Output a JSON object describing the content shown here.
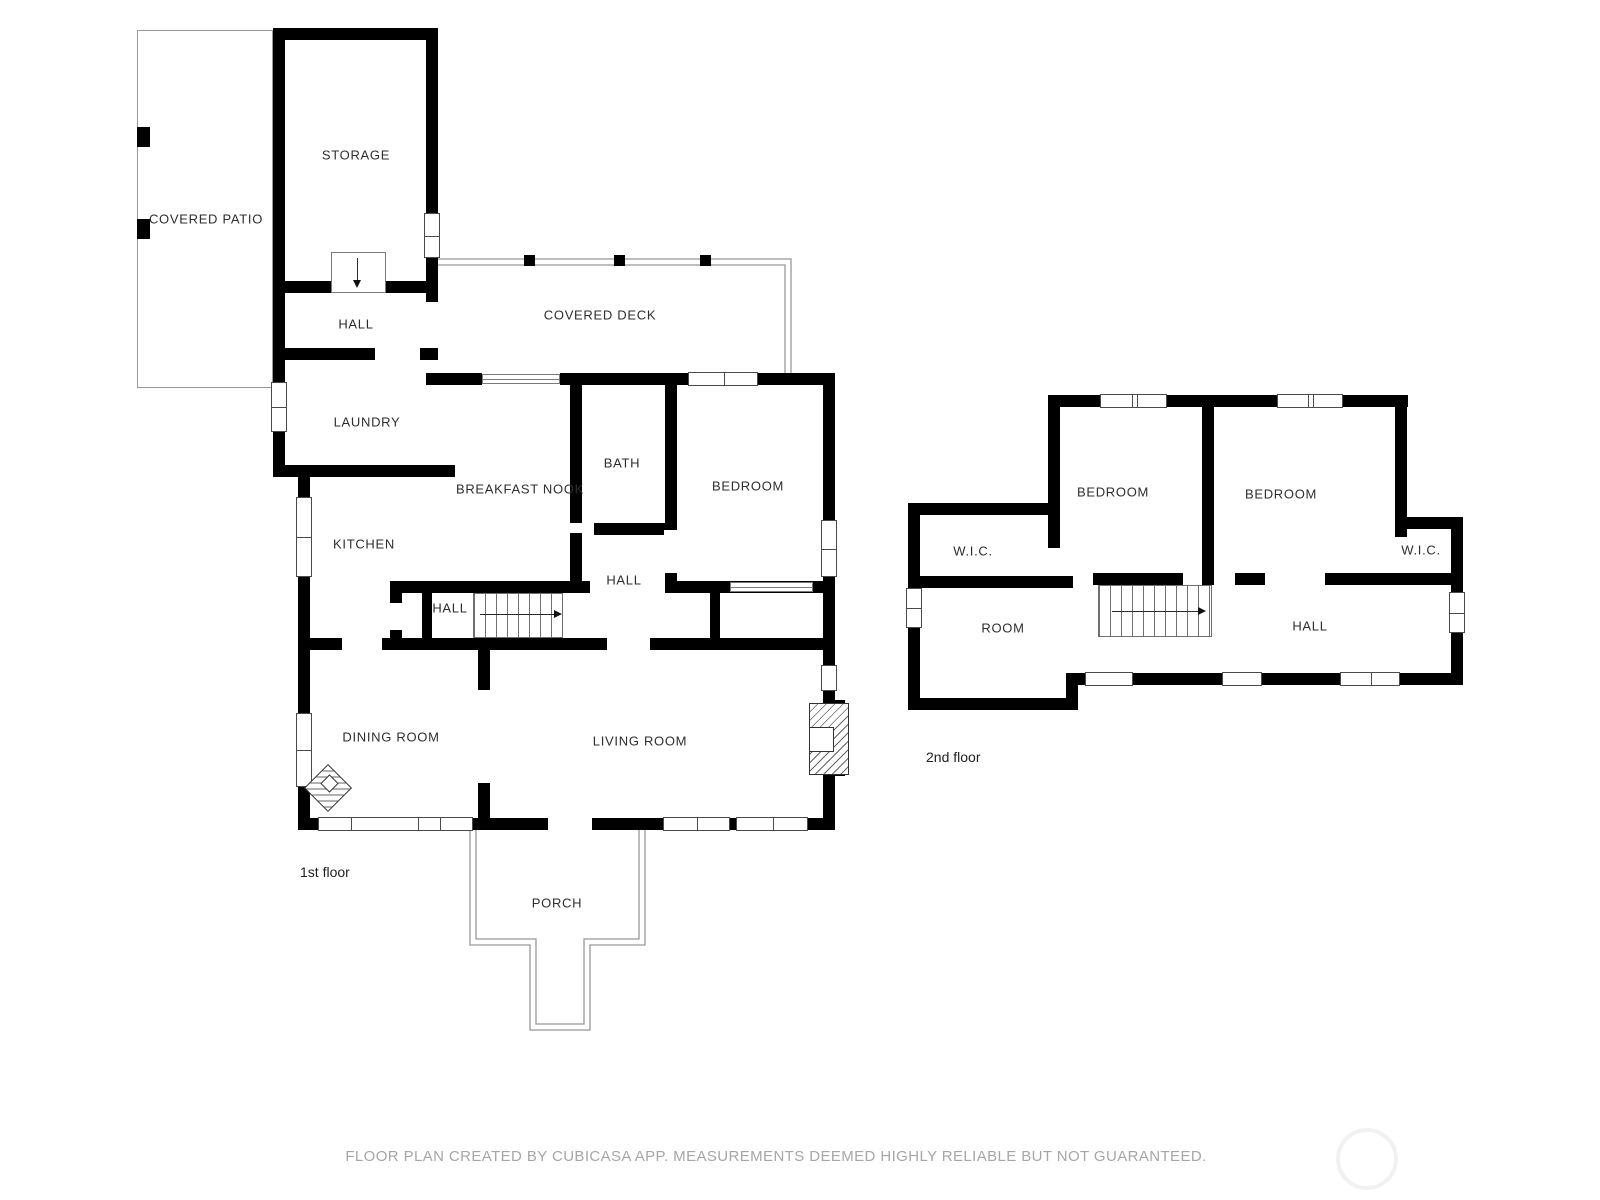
{
  "floor1": {
    "name": "1st floor",
    "rooms": {
      "covered_patio": "COVERED PATIO",
      "storage": "STORAGE",
      "hall_upper": "HALL",
      "covered_deck": "COVERED DECK",
      "laundry": "LAUNDRY",
      "breakfast_nook": "BREAKFAST NOOK",
      "bath": "BATH",
      "bedroom": "BEDROOM",
      "kitchen": "KITCHEN",
      "hall_center": "HALL",
      "hall_stairs": "HALL",
      "dining_room": "DINING ROOM",
      "living_room": "LIVING ROOM",
      "porch": "PORCH"
    }
  },
  "floor2": {
    "name": "2nd floor",
    "rooms": {
      "bedroom_left": "BEDROOM",
      "bedroom_right": "BEDROOM",
      "wic_left": "W.I.C.",
      "wic_right": "W.I.C.",
      "room": "ROOM",
      "hall": "HALL"
    }
  },
  "footer": {
    "disclaimer": "FLOOR PLAN CREATED BY CUBICASA APP. MEASUREMENTS DEEMED HIGHLY RELIABLE BUT NOT GUARANTEED."
  },
  "colors": {
    "wall": "#000000",
    "label": "#2e2e2e",
    "outline": "#989898",
    "footer_text": "#a6a6a6"
  }
}
